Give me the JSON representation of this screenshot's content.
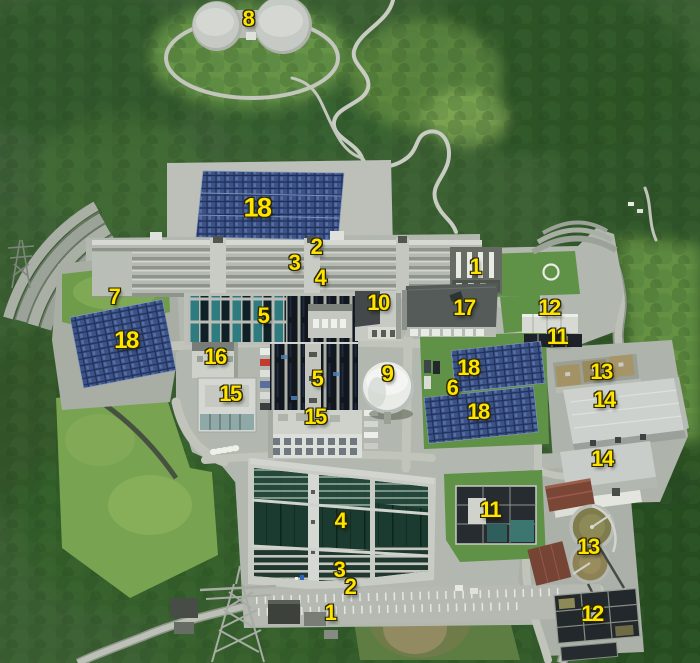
{
  "palette": {
    "label_yellow": "#ffe400",
    "label_outline": "#2a2600",
    "forest_green": "#3c6033",
    "lawn_green": "#5f9146",
    "concrete_gray": "#b2b7af",
    "solar_blue": "#3d5388",
    "basin_water": "#1b3a30",
    "filter_teal": "#2e7b80",
    "roof_dark": "#545b58",
    "roof_red": "#7a4636",
    "tank_white": "#e9ebe7"
  },
  "annotations": [
    {
      "number": "8",
      "x": 248,
      "y": 19,
      "size": 22
    },
    {
      "number": "18",
      "x": 257,
      "y": 208,
      "size": 27
    },
    {
      "number": "2",
      "x": 316,
      "y": 247,
      "size": 22
    },
    {
      "number": "3",
      "x": 294,
      "y": 263,
      "size": 22
    },
    {
      "number": "4",
      "x": 320,
      "y": 278,
      "size": 22
    },
    {
      "number": "1",
      "x": 475,
      "y": 267,
      "size": 22
    },
    {
      "number": "7",
      "x": 114,
      "y": 297,
      "size": 22
    },
    {
      "number": "10",
      "x": 378,
      "y": 303,
      "size": 22
    },
    {
      "number": "17",
      "x": 464,
      "y": 308,
      "size": 22
    },
    {
      "number": "12",
      "x": 549,
      "y": 308,
      "size": 22
    },
    {
      "number": "5",
      "x": 263,
      "y": 316,
      "size": 22
    },
    {
      "number": "18",
      "x": 126,
      "y": 341,
      "size": 24
    },
    {
      "number": "11",
      "x": 557,
      "y": 337,
      "size": 22
    },
    {
      "number": "16",
      "x": 215,
      "y": 357,
      "size": 22
    },
    {
      "number": "18",
      "x": 468,
      "y": 368,
      "size": 22
    },
    {
      "number": "13",
      "x": 601,
      "y": 372,
      "size": 22
    },
    {
      "number": "9",
      "x": 387,
      "y": 374,
      "size": 22
    },
    {
      "number": "5",
      "x": 317,
      "y": 379,
      "size": 22
    },
    {
      "number": "6",
      "x": 452,
      "y": 388,
      "size": 22
    },
    {
      "number": "15",
      "x": 230,
      "y": 394,
      "size": 22
    },
    {
      "number": "14",
      "x": 604,
      "y": 400,
      "size": 22
    },
    {
      "number": "18",
      "x": 478,
      "y": 412,
      "size": 22
    },
    {
      "number": "15",
      "x": 315,
      "y": 417,
      "size": 22
    },
    {
      "number": "14",
      "x": 602,
      "y": 459,
      "size": 22
    },
    {
      "number": "11",
      "x": 490,
      "y": 510,
      "size": 22
    },
    {
      "number": "4",
      "x": 340,
      "y": 521,
      "size": 22
    },
    {
      "number": "13",
      "x": 588,
      "y": 547,
      "size": 22
    },
    {
      "number": "3",
      "x": 339,
      "y": 570,
      "size": 22
    },
    {
      "number": "2",
      "x": 350,
      "y": 587,
      "size": 22
    },
    {
      "number": "1",
      "x": 330,
      "y": 613,
      "size": 22
    },
    {
      "number": "12",
      "x": 592,
      "y": 614,
      "size": 22
    }
  ]
}
